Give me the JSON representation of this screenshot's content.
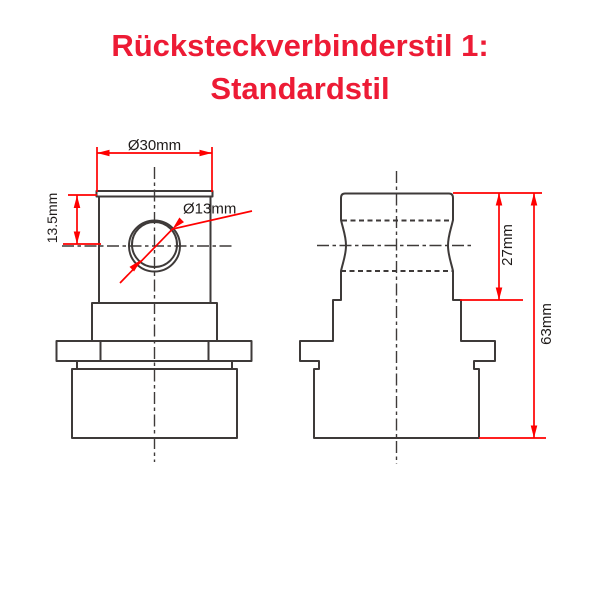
{
  "title": {
    "line1": "Rücksteckverbinderstil 1:",
    "line2": "Standardstil"
  },
  "colors": {
    "title": "#ed1b35",
    "dimension": "#ff0000",
    "outline": "#3e3a39",
    "label": "#1f1b1a",
    "background": "#ffffff"
  },
  "drawing": {
    "front_view": {
      "dim_outer_width": "Ø30mm",
      "dim_hole_offset": "13.5mm",
      "dim_hole_diameter": "Ø13mm"
    },
    "side_view": {
      "dim_upper_height": "27mm",
      "dim_total_height": "63mm"
    }
  }
}
